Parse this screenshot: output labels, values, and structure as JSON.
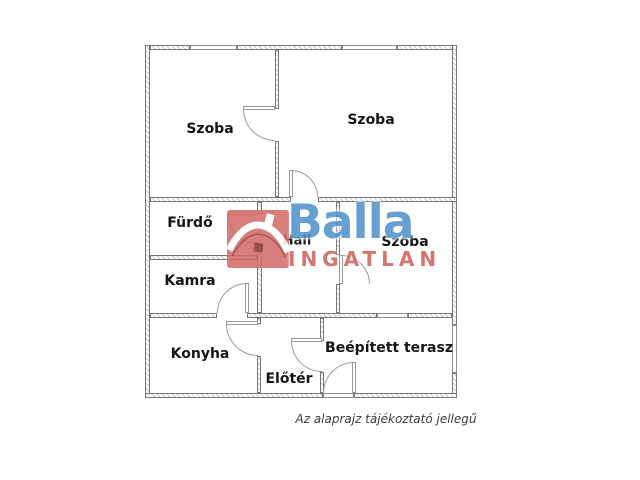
{
  "caption": "Az alaprajz tájékoztató jellegű",
  "watermark": {
    "brand": "Balla",
    "subbrand": "INGATLAN",
    "icon": "house-roof-icon",
    "brand_color": "#4e93cc",
    "subbrand_color": "#d05f5f",
    "icon_color": "#d46a6a",
    "icon_detail_color": "#8d3c3c"
  },
  "colors": {
    "wall_outline": "#767676",
    "wall_hatch": "#c9c9c9",
    "door_line": "#9a9a9a",
    "label_text": "#141414",
    "caption_text": "#3c3c3c",
    "background": "#ffffff"
  },
  "rooms": [
    {
      "label": "Szoba",
      "cx": 210,
      "cy": 129,
      "size": 14
    },
    {
      "label": "Szoba",
      "cx": 371,
      "cy": 120,
      "size": 14
    },
    {
      "label": "Fürdő",
      "cx": 190,
      "cy": 223,
      "size": 14
    },
    {
      "label": "Hall",
      "cx": 297,
      "cy": 241,
      "size": 13
    },
    {
      "label": "Szoba",
      "cx": 405,
      "cy": 242,
      "size": 14
    },
    {
      "label": "Kamra",
      "cx": 190,
      "cy": 281,
      "size": 14
    },
    {
      "label": "Konyha",
      "cx": 200,
      "cy": 354,
      "size": 14
    },
    {
      "label": "Előtér",
      "cx": 289,
      "cy": 379,
      "size": 14
    },
    {
      "label": "Beépített terasz",
      "cx": 389,
      "cy": 348,
      "size": 14
    }
  ],
  "floorplan": {
    "walls": [
      [
        150,
        45,
        40,
        5
      ],
      [
        237,
        45,
        105,
        5
      ],
      [
        397,
        45,
        60,
        5
      ],
      [
        145,
        45,
        5,
        353
      ],
      [
        452,
        45,
        5,
        280
      ],
      [
        452,
        373,
        5,
        25
      ],
      [
        145,
        393,
        178,
        5
      ],
      [
        354,
        393,
        103,
        5
      ],
      [
        150,
        197,
        141,
        5
      ],
      [
        318,
        197,
        139,
        5
      ],
      [
        275,
        50,
        4,
        59
      ],
      [
        275,
        141,
        4,
        56
      ],
      [
        257,
        202,
        5,
        12
      ],
      [
        257,
        244,
        5,
        69
      ],
      [
        150,
        255,
        107,
        5
      ],
      [
        336,
        202,
        4,
        53
      ],
      [
        336,
        284,
        4,
        29
      ],
      [
        150,
        313,
        67,
        5
      ],
      [
        247,
        313,
        130,
        5
      ],
      [
        408,
        313,
        44,
        5
      ],
      [
        257,
        318,
        4,
        6
      ],
      [
        257,
        356,
        4,
        37
      ],
      [
        320,
        318,
        4,
        23
      ],
      [
        320,
        372,
        4,
        21
      ]
    ],
    "windows": [
      [
        190,
        45,
        47,
        5
      ],
      [
        342,
        45,
        55,
        5
      ],
      [
        377,
        313,
        31,
        5
      ],
      [
        452,
        325,
        5,
        48
      ],
      [
        323,
        393,
        31,
        5
      ]
    ],
    "doors": [
      {
        "box": [
          243,
          109,
          32
        ],
        "corner": "bl",
        "leaf": [
          243,
          106,
          32,
          4
        ]
      },
      {
        "box": [
          291,
          170,
          27
        ],
        "corner": "tr",
        "leaf": [
          289,
          170,
          4,
          27
        ]
      },
      {
        "box": [
          228,
          214,
          30
        ],
        "corner": "bl",
        "leaf": [
          228,
          211,
          30,
          4
        ]
      },
      {
        "box": [
          217,
          283,
          30
        ],
        "corner": "tl",
        "leaf": [
          245,
          283,
          4,
          30
        ]
      },
      {
        "box": [
          226,
          324,
          32
        ],
        "corner": "bl",
        "leaf": [
          226,
          321,
          32,
          4
        ]
      },
      {
        "box": [
          291,
          341,
          31
        ],
        "corner": "bl",
        "leaf": [
          291,
          338,
          31,
          4
        ]
      },
      {
        "box": [
          341,
          255,
          29
        ],
        "corner": "tr",
        "leaf": [
          339,
          255,
          4,
          29
        ]
      },
      {
        "box": [
          323,
          362,
          31
        ],
        "corner": "tl",
        "leaf": [
          352,
          362,
          4,
          31
        ]
      }
    ]
  }
}
